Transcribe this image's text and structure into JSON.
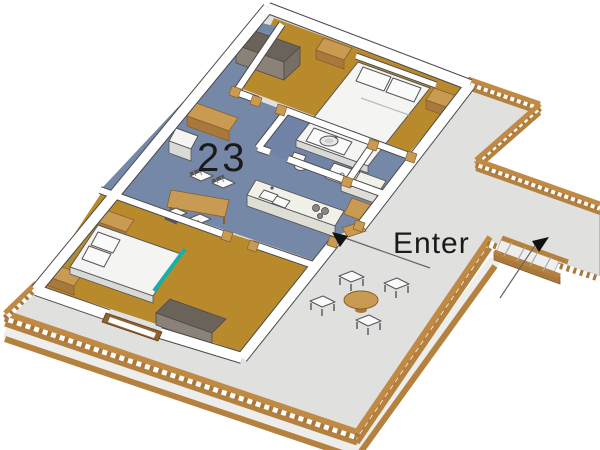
{
  "annotations": {
    "unit_number": "23",
    "enter": "Enter"
  },
  "icons": {
    "enter_arrow": "arrowhead pointing to entry door",
    "stairs_arrow": "arrowhead pointing to deck stairs"
  },
  "colors": {
    "background": "#ffffff",
    "deck_surface": "#e0e0de",
    "deck_wood": "#c08a45",
    "deck_wood_dark": "#8f6230",
    "bedroom_floor": "#b98a2c",
    "living_floor": "#7688a8",
    "bathroom_floor": "#7183a6",
    "wall_fill": "#ffffff",
    "wall_outline": "#4a4a4a",
    "bed_frame_teal": "#19afa8",
    "furniture_wood": "#c89a52",
    "wardrobe": "#8a8178",
    "annotation_text": "#1a1a1a"
  }
}
